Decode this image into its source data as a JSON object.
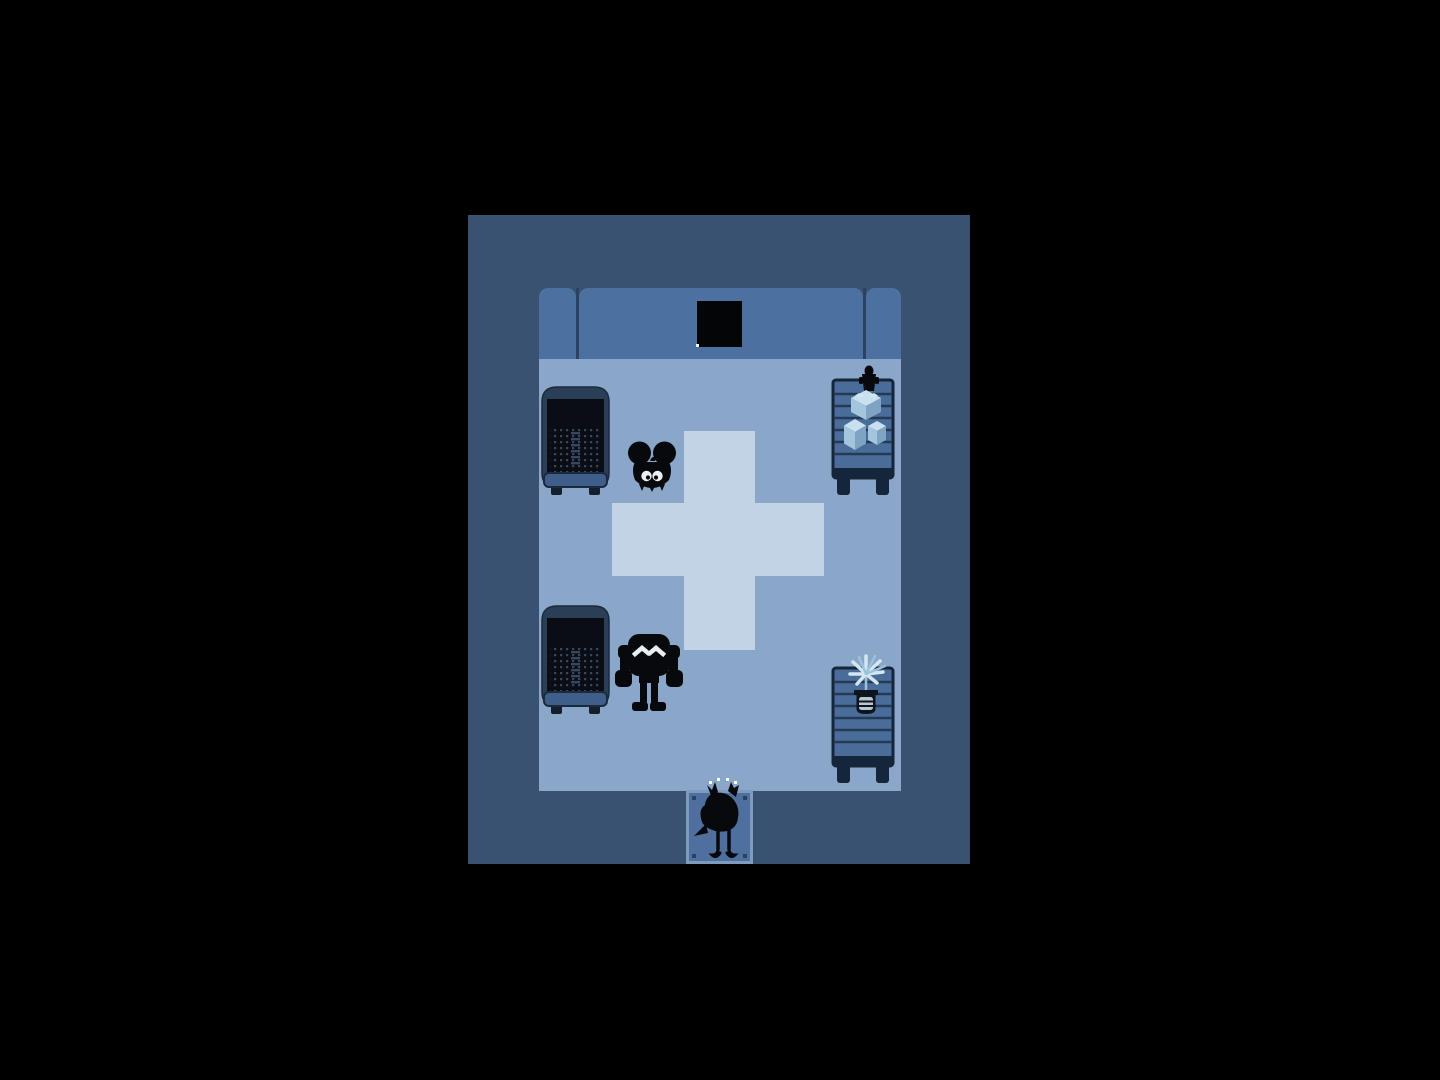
{
  "palette": {
    "bg": "#000000",
    "wall": "#3a5271",
    "couch": "#4c70a0",
    "couch_divider": "#2b4262",
    "floor": "#8aa6c8",
    "cross": "#c2d3e6",
    "window": "#040507",
    "sparkle": "#ffffff",
    "door_fill": "#4f709e",
    "door_border": "#7e9abd",
    "door_dot": "#2b4162",
    "sprite": "#07090d",
    "eye_white": "#e9eef3",
    "bed_rim": "#2b3e57",
    "bed_body": "#0a0e14",
    "bed_dots": "#36485f",
    "bed_foot": "#3f5e8a",
    "bed_leg": "#141f2c",
    "bed_outline": "#1b2a3d",
    "cart_body": "#4a6c98",
    "cart_line": "#223a55",
    "cart_dark": "#16263a",
    "cube_top": "#c9e0ef",
    "cube_left": "#a4c6dc",
    "cube_right": "#7fa3c2",
    "plant_light": "#d3e7f2",
    "plant_mid": "#9cc2da",
    "pot_dark": "#0d141c",
    "pot_light": "#b9c6d2"
  },
  "scene": {
    "viewport": {
      "width": 1440,
      "height": 1080
    },
    "entities": [
      "dark-room-walls",
      "top-wall-couch",
      "dark-wall-window",
      "window-sparkle",
      "light-floor",
      "medical-cross-rug",
      "hospital-bed-top",
      "hospital-bed-bottom",
      "round-eared-creature",
      "brute-creature",
      "supply-cart-with-cubes",
      "figurine-on-cart",
      "supply-cart-with-plant",
      "potted-ice-plant",
      "door-tile",
      "bird-character",
      "bird-emote-dots"
    ]
  }
}
